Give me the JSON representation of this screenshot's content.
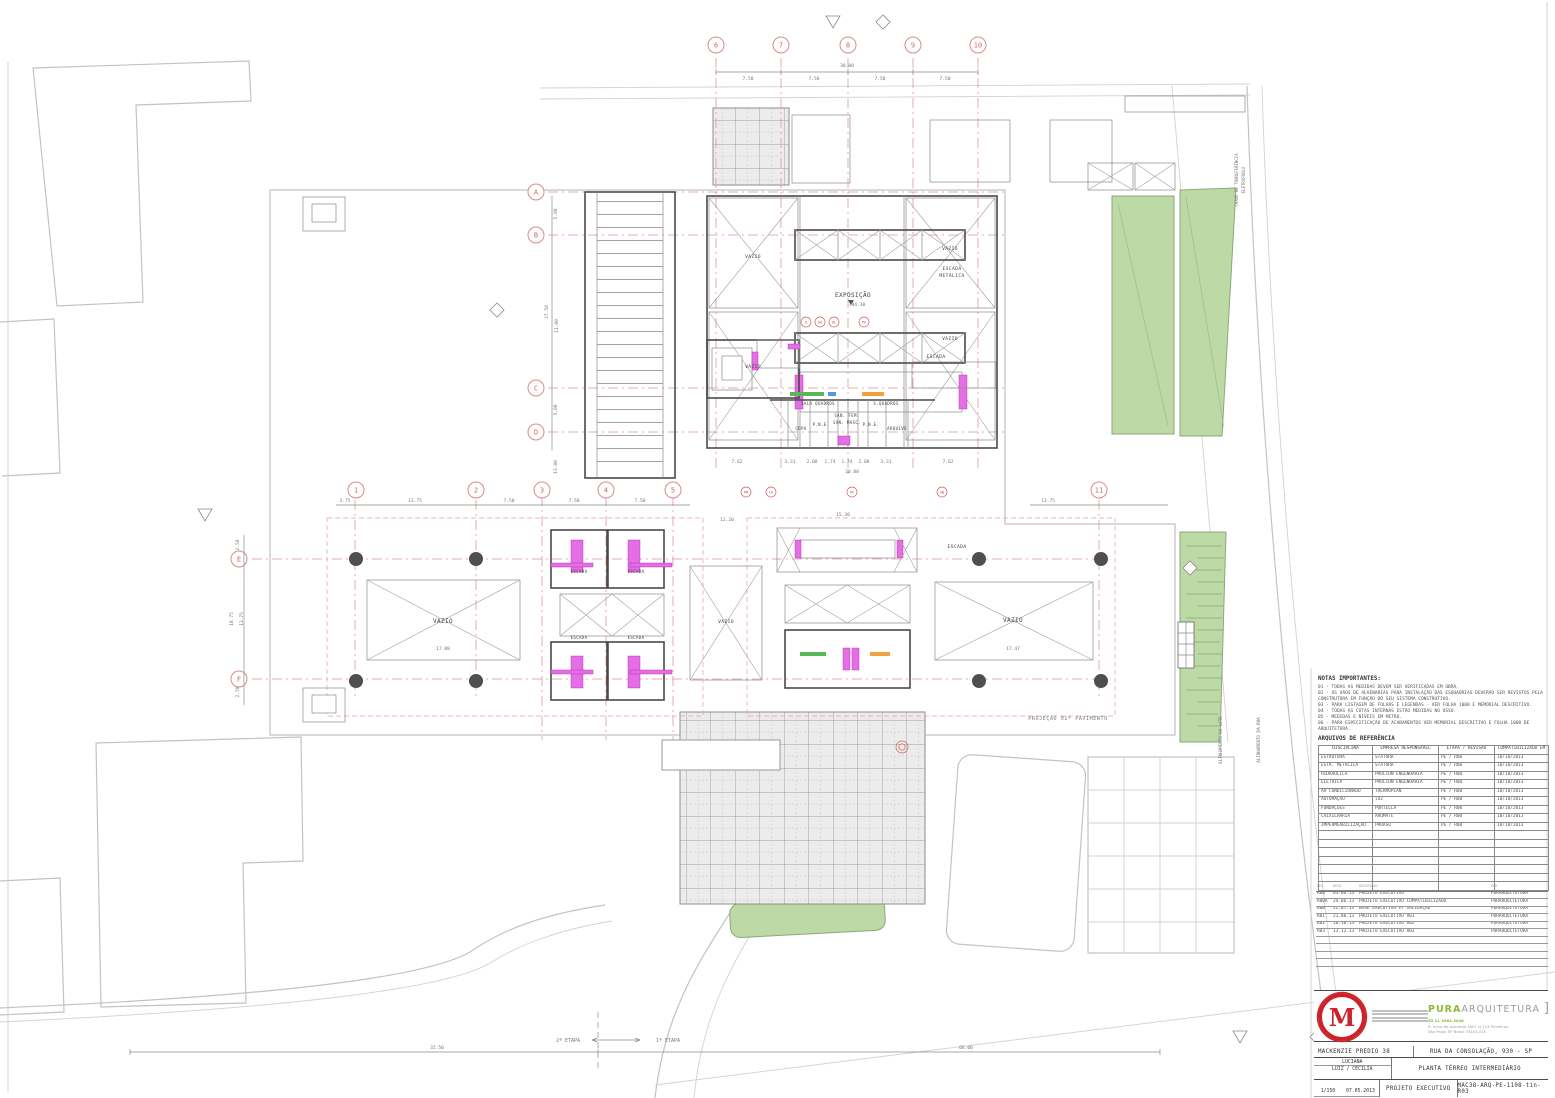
{
  "plan": {
    "grid": {
      "cols": [
        "1",
        "2",
        "3",
        "4",
        "5",
        "6",
        "7",
        "8",
        "9",
        "10",
        "11"
      ],
      "rows": [
        "A",
        "B",
        "C",
        "D",
        "E",
        "F"
      ]
    },
    "rooms": {
      "vazio": "VAZIO",
      "exposicao": "EXPOSIÇÃO",
      "escada": "ESCADA",
      "metalica": "METÁLICA",
      "sala_quadros": "SALA QUADROS",
      "s_quadros": "S.QUADROS",
      "copa": "COPA",
      "pne": "P.N.E.",
      "san_fem": "SAN. FEM.",
      "san_masc": "SAN. MASC.",
      "arquivo": "ARQUIVO"
    },
    "annotations": {
      "level": "784.30",
      "projecao": "PROJEÇÃO 01º PAVIMENTO",
      "alinhamento_lote": "ALINHAMENTO DO LOTE",
      "alinhamento_rua": "ALINHAMENTO DA RUA",
      "chave1": "CHAVE DE TRANSFERÊNCIA",
      "chave2": "ELETROPAULO",
      "etapa2": "2ª ETAPA",
      "etapa1": "1ª ETAPA"
    },
    "dims": {
      "d3000": "30.00",
      "d750": "7.50",
      "d375": "3.75",
      "d1375": "13.75",
      "d500": "5.00",
      "d2750": "27.50",
      "d1100": "11.00",
      "d1300": "13.00",
      "d250": "2.50",
      "d1875": "18.75",
      "d1788": "17.88",
      "d1747": "17.47",
      "d1220": "12.20",
      "d1530": "15.30",
      "d3080": "30.80",
      "d762": "7.62",
      "d3250": "32.50",
      "d6600": "66.00",
      "d331": "3.31",
      "d208": "2.08",
      "d174": "1.74"
    },
    "tags": [
      "A",
      "GA",
      "AL",
      "PG",
      "PM",
      "CA",
      "PE",
      "GB"
    ]
  },
  "notes": {
    "title": "NOTAS IMPORTANTES:",
    "items": [
      "01 - TODAS AS MEDIDAS DEVEM SER VERIFICADAS EM OBRA.",
      "02 - OS VÃOS DE ALVENARIAS PARA INSTALAÇÃO DAS ESQUADRIAS DEVERÃO SER REVISTOS PELA CONSTRUTORA EM FUNÇÃO DO SEU SISTEMA CONSTRUTIVO.",
      "03 - PARA LISTAGEM DE FOLHAS E LEGENDAS  - VER FOLHA 1000 E MEMORIAL DESCRITIVO.",
      "04 - TODAS AS COTAS INTERNAS ESTÃO MEDIDAS NO OSSO.",
      "05 - MEDIDAS E NÍVEIS EM METRO.",
      "06 - PARA ESPECIFICAÇÃO DE ACABAMENTOS VER MEMORIAL DESCRITIVO E FOLHA 1000 DE ARQUITETURA."
    ]
  },
  "reference": {
    "title": "ARQUIVOS DE REFERÊNCIA",
    "headers": [
      "DISCIPLINA",
      "EMPRESA RESPONSÁVEL",
      "ETAPA / REVISÃO",
      "COMPATIBILIZADO EM"
    ],
    "rows": [
      [
        "ESTRUTURA",
        "STATURA",
        "PE / R00",
        "18/10/2013"
      ],
      [
        "ESTR. METÁLICA",
        "STATURA",
        "PE / R00",
        "18/10/2013"
      ],
      [
        "HIDRÁULICA",
        "PROCION ENGENHARIA",
        "PE / R00",
        "18/10/2013"
      ],
      [
        "ELÉTRICA",
        "PROCION ENGENHARIA",
        "PE / R00",
        "18/10/2013"
      ],
      [
        "AR CONDICIONADO",
        "THERMOPLAN",
        "PE / R00",
        "18/10/2013"
      ],
      [
        "AUTOMAÇÃO",
        "id2",
        "PE / R00",
        "18/10/2013"
      ],
      [
        "FUNDAÇÕES",
        "PORTELLA",
        "PE / R00",
        "18/10/2013"
      ],
      [
        "CAIXILHARIA",
        "ARQMATE",
        "PE / R00",
        "18/10/2013"
      ],
      [
        "IMPERMEABILIZAÇÃO",
        "PROASO",
        "PE / R00",
        "18/10/2013"
      ]
    ]
  },
  "revisions": {
    "headers": [
      "REV.",
      "DATA",
      "DESCRIÇÃO",
      "POR"
    ],
    "rows": [
      [
        "R00",
        "03.06.13",
        "PROJETO EXECUTIVO",
        "PURARQUITETURA"
      ],
      [
        "R00A",
        "24.06.13",
        "PROJETO EXECUTIVO COMPATIBILIZADO",
        "PURARQUITETURA"
      ],
      [
        "R0B",
        "22.07.13",
        "BASE EXECUTIVO P/ VALIDAÇÃO",
        "PURARQUITETURA"
      ],
      [
        "R01",
        "21.08.13",
        "PROJETO EXECUTIVO R01",
        "PURARQUITETURA"
      ],
      [
        "R02",
        "18.10.13",
        "PROJETO EXECUTIVO R02",
        "PURARQUITETURA"
      ],
      [
        "R03",
        "13.12.13",
        "PROJETO EXECUTIVO R03",
        "PURARQUITETURA"
      ]
    ]
  },
  "title_block": {
    "logo_letter": "M",
    "firm_bold": "PURA",
    "firm_rest": "ARQUITETURA",
    "firm_phone": "55 11 3064.3048",
    "firm_addr1": "R. Artur de Azevedo 1857 cj 114 Pinheiros",
    "firm_addr2": "São Paulo SP Brasil 05404-015",
    "project": "MACKENZIE  PREDIO  38",
    "address": "RUA  DA  CONSOLAÇÃO,  930  -  SP",
    "author": "LUCIANA",
    "coordination": "LUIZ / CECILIA",
    "sheet_title": "PLANTA  TÉRREO  INTERMEDIÁRIO",
    "phase": "PROJETO  EXECUTIVO",
    "scale": "1/150",
    "date": "07.05.2013",
    "doc_number": "MAC38-ARQ-PE-1108-tin-R03"
  }
}
